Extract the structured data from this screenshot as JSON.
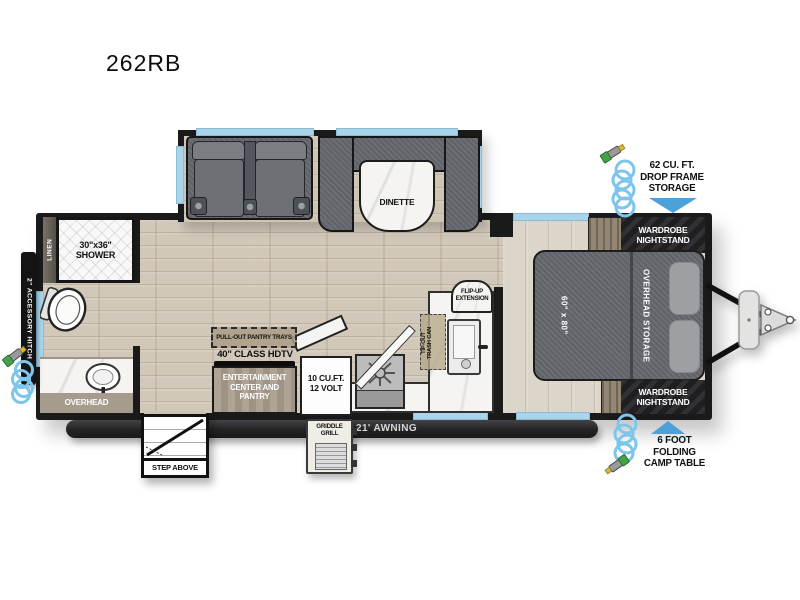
{
  "title": "262RB",
  "colors": {
    "wall": "#1a1a1b",
    "window_blue": "#a9d5ec",
    "arrow_blue": "#4aa2d8",
    "hose_blue": "#7cc6ec",
    "floor_wood": "#cfc5b5",
    "bedroom_floor": "#dcd5c9",
    "fabric_gray": "#64686d",
    "cabinet_tan": "#a89c8c",
    "dark_cabinet": "#242427",
    "marble": "#f5f4f1",
    "awning_bar": "#2c2c2e"
  },
  "exterior": {
    "drop_frame_storage": {
      "line1": "62 CU. FT.",
      "line2": "DROP FRAME",
      "line3": "STORAGE"
    },
    "camp_table": {
      "line1": "6 FOOT",
      "line2": "FOLDING",
      "line3": "CAMP TABLE"
    },
    "awning": "21' AWNING",
    "griddle": {
      "line1": "GRIDDLE",
      "line2": "GRILL"
    },
    "entry_step": "STEP ABOVE",
    "accessory_hitch": "2\" ACCESSORY HITCH"
  },
  "bathroom": {
    "shower": {
      "size": "30\"x36\"",
      "label": "SHOWER"
    },
    "linen": "LINEN",
    "vanity": "OVERHEAD"
  },
  "living_area": {
    "dinette": "DINETTE"
  },
  "kitchen": {
    "pantry_label": "PULL-OUT PANTRY TRAYS",
    "tv": "40\" CLASS HDTV",
    "entertainment": {
      "line1": "ENTERTAINMENT",
      "line2": "CENTER AND",
      "line3": "PANTRY"
    },
    "fridge": {
      "line1": "10 CU.FT.",
      "line2": "12 VOLT"
    },
    "flip_up": {
      "line1": "FLIP-UP",
      "line2": "EXTENSION"
    },
    "trash": {
      "line1": "TIP-OUT",
      "line2": "TRASH CAN"
    }
  },
  "bedroom": {
    "bed_size": "60\" x 80\"",
    "overhead_storage": "OVERHEAD STORAGE",
    "wardrobe": {
      "line1": "WARDROBE",
      "line2": "NIGHTSTAND"
    }
  }
}
